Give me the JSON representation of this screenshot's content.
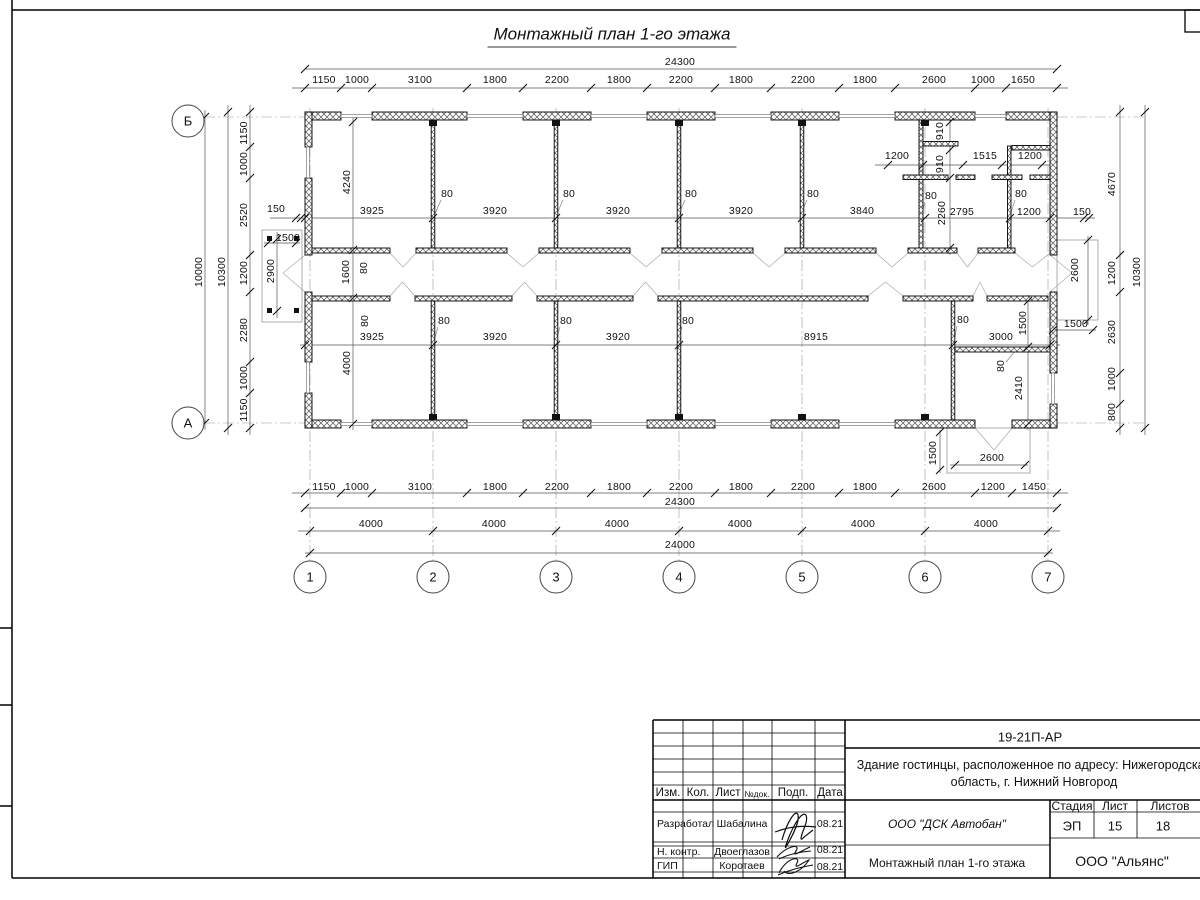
{
  "sheet": {
    "title": "Монтажный план 1-го этажа"
  },
  "plan": {
    "labels": [
      {
        "t": "24300",
        "x": 680,
        "y": 62
      },
      {
        "t": "1150",
        "x": 324,
        "y": 80
      },
      {
        "t": "1000",
        "x": 357,
        "y": 80
      },
      {
        "t": "3100",
        "x": 420,
        "y": 80
      },
      {
        "t": "1800",
        "x": 495,
        "y": 80
      },
      {
        "t": "2200",
        "x": 557,
        "y": 80
      },
      {
        "t": "1800",
        "x": 619,
        "y": 80
      },
      {
        "t": "2200",
        "x": 681,
        "y": 80
      },
      {
        "t": "1800",
        "x": 741,
        "y": 80
      },
      {
        "t": "2200",
        "x": 803,
        "y": 80
      },
      {
        "t": "1800",
        "x": 865,
        "y": 80
      },
      {
        "t": "2600",
        "x": 934,
        "y": 80
      },
      {
        "t": "1000",
        "x": 983,
        "y": 80
      },
      {
        "t": "1650",
        "x": 1023,
        "y": 80
      },
      {
        "t": "1150",
        "x": 244,
        "y": 133,
        "r": 1
      },
      {
        "t": "1000",
        "x": 244,
        "y": 164,
        "r": 1
      },
      {
        "t": "2520",
        "x": 244,
        "y": 215,
        "r": 1
      },
      {
        "t": "1200",
        "x": 244,
        "y": 273,
        "r": 1
      },
      {
        "t": "2280",
        "x": 244,
        "y": 330,
        "r": 1
      },
      {
        "t": "1000",
        "x": 244,
        "y": 378,
        "r": 1
      },
      {
        "t": "1150",
        "x": 244,
        "y": 410,
        "r": 1
      },
      {
        "t": "10300",
        "x": 222,
        "y": 272,
        "r": 1
      },
      {
        "t": "10000",
        "x": 199,
        "y": 272,
        "r": 1
      },
      {
        "t": "4670",
        "x": 1112,
        "y": 184,
        "r": 1
      },
      {
        "t": "1200",
        "x": 1112,
        "y": 273,
        "r": 1
      },
      {
        "t": "2630",
        "x": 1112,
        "y": 332,
        "r": 1
      },
      {
        "t": "1000",
        "x": 1112,
        "y": 379,
        "r": 1
      },
      {
        "t": "800",
        "x": 1112,
        "y": 412,
        "r": 1
      },
      {
        "t": "10300",
        "x": 1137,
        "y": 272,
        "r": 1
      },
      {
        "t": "1150",
        "x": 324,
        "y": 487
      },
      {
        "t": "1000",
        "x": 357,
        "y": 487
      },
      {
        "t": "3100",
        "x": 420,
        "y": 487
      },
      {
        "t": "1800",
        "x": 495,
        "y": 487
      },
      {
        "t": "2200",
        "x": 557,
        "y": 487
      },
      {
        "t": "1800",
        "x": 619,
        "y": 487
      },
      {
        "t": "2200",
        "x": 681,
        "y": 487
      },
      {
        "t": "1800",
        "x": 741,
        "y": 487
      },
      {
        "t": "2200",
        "x": 803,
        "y": 487
      },
      {
        "t": "1800",
        "x": 865,
        "y": 487
      },
      {
        "t": "2600",
        "x": 934,
        "y": 487
      },
      {
        "t": "1200",
        "x": 993,
        "y": 487
      },
      {
        "t": "1450",
        "x": 1034,
        "y": 487
      },
      {
        "t": "24300",
        "x": 680,
        "y": 502
      },
      {
        "t": "4000",
        "x": 371,
        "y": 524
      },
      {
        "t": "4000",
        "x": 494,
        "y": 524
      },
      {
        "t": "4000",
        "x": 617,
        "y": 524
      },
      {
        "t": "4000",
        "x": 740,
        "y": 524
      },
      {
        "t": "4000",
        "x": 863,
        "y": 524
      },
      {
        "t": "4000",
        "x": 986,
        "y": 524
      },
      {
        "t": "24000",
        "x": 680,
        "y": 545
      },
      {
        "t": "150",
        "x": 276,
        "y": 209
      },
      {
        "t": "3925",
        "x": 372,
        "y": 211
      },
      {
        "t": "3920",
        "x": 495,
        "y": 211
      },
      {
        "t": "3920",
        "x": 618,
        "y": 211
      },
      {
        "t": "3920",
        "x": 741,
        "y": 211
      },
      {
        "t": "3840",
        "x": 862,
        "y": 211
      },
      {
        "t": "2795",
        "x": 962,
        "y": 212
      },
      {
        "t": "1200",
        "x": 1029,
        "y": 212
      },
      {
        "t": "150",
        "x": 1082,
        "y": 212
      },
      {
        "t": "80",
        "x": 447,
        "y": 194
      },
      {
        "t": "80",
        "x": 569,
        "y": 194
      },
      {
        "t": "80",
        "x": 691,
        "y": 194
      },
      {
        "t": "80",
        "x": 813,
        "y": 194
      },
      {
        "t": "80",
        "x": 931,
        "y": 196
      },
      {
        "t": "80",
        "x": 1021,
        "y": 194
      },
      {
        "t": "4240",
        "x": 347,
        "y": 182,
        "r": 1
      },
      {
        "t": "1600",
        "x": 346,
        "y": 272,
        "r": 1
      },
      {
        "t": "80",
        "x": 364,
        "y": 268,
        "r": 1
      },
      {
        "t": "2900",
        "x": 271,
        "y": 271,
        "r": 1
      },
      {
        "t": "1500",
        "x": 288,
        "y": 238
      },
      {
        "t": "910",
        "x": 940,
        "y": 131,
        "r": 1
      },
      {
        "t": "910",
        "x": 940,
        "y": 164,
        "r": 1
      },
      {
        "t": "2260",
        "x": 942,
        "y": 213,
        "r": 1
      },
      {
        "t": "1200",
        "x": 897,
        "y": 156
      },
      {
        "t": "1515",
        "x": 985,
        "y": 156
      },
      {
        "t": "1200",
        "x": 1030,
        "y": 156
      },
      {
        "t": "2600",
        "x": 1075,
        "y": 270,
        "r": 1
      },
      {
        "t": "1500",
        "x": 1076,
        "y": 324
      },
      {
        "t": "3925",
        "x": 372,
        "y": 337
      },
      {
        "t": "3920",
        "x": 495,
        "y": 337
      },
      {
        "t": "3920",
        "x": 618,
        "y": 337
      },
      {
        "t": "8915",
        "x": 816,
        "y": 337
      },
      {
        "t": "3000",
        "x": 1001,
        "y": 337
      },
      {
        "t": "80",
        "x": 444,
        "y": 321
      },
      {
        "t": "80",
        "x": 566,
        "y": 321
      },
      {
        "t": "80",
        "x": 688,
        "y": 321
      },
      {
        "t": "80",
        "x": 963,
        "y": 320
      },
      {
        "t": "80",
        "x": 365,
        "y": 321,
        "r": 1
      },
      {
        "t": "4000",
        "x": 347,
        "y": 363,
        "r": 1
      },
      {
        "t": "1500",
        "x": 1023,
        "y": 323,
        "r": 1
      },
      {
        "t": "80",
        "x": 1001,
        "y": 366,
        "r": 1
      },
      {
        "t": "2410",
        "x": 1019,
        "y": 388,
        "r": 1
      },
      {
        "t": "1500",
        "x": 933,
        "y": 453,
        "r": 1
      },
      {
        "t": "2600",
        "x": 992,
        "y": 458
      }
    ]
  },
  "grid": {
    "bubbles": [
      {
        "t": "Б",
        "x": 188,
        "y": 121
      },
      {
        "t": "А",
        "x": 188,
        "y": 423
      },
      {
        "t": "1",
        "x": 310,
        "y": 577
      },
      {
        "t": "2",
        "x": 433,
        "y": 577
      },
      {
        "t": "3",
        "x": 556,
        "y": 577
      },
      {
        "t": "4",
        "x": 679,
        "y": 577
      },
      {
        "t": "5",
        "x": 802,
        "y": 577
      },
      {
        "t": "6",
        "x": 925,
        "y": 577
      },
      {
        "t": "7",
        "x": 1048,
        "y": 577
      }
    ]
  },
  "titleblock": {
    "doc_code": "19-21П-АР",
    "object_desc_line1": "Здание гостинцы, расположенное по адресу: Нижегородская",
    "object_desc_line2": "область, г. Нижний Новгород",
    "cols": {
      "izm": "Изм.",
      "kol": "Кол.",
      "list": "Лист",
      "ndok": "№док.",
      "podp": "Подп.",
      "data": "Дата"
    },
    "rows": [
      {
        "role": "Разработал",
        "name": "Шабалина",
        "date": "08.21"
      },
      {
        "role": "Н. контр.",
        "name": "Двоеглазов",
        "date": "08.21"
      },
      {
        "role": "ГИП",
        "name": "Коротаев",
        "date": "08.21"
      }
    ],
    "org": "ООО \"ДСК Автобан\"",
    "drawing_name": "Монтажный план 1-го этажа",
    "stage_label": "Стадия",
    "sheet_label": "Лист",
    "sheets_label": "Листов",
    "stage": "ЭП",
    "sheet_no": "15",
    "sheets_total": "18",
    "company": "ООО \"Альянс\""
  }
}
